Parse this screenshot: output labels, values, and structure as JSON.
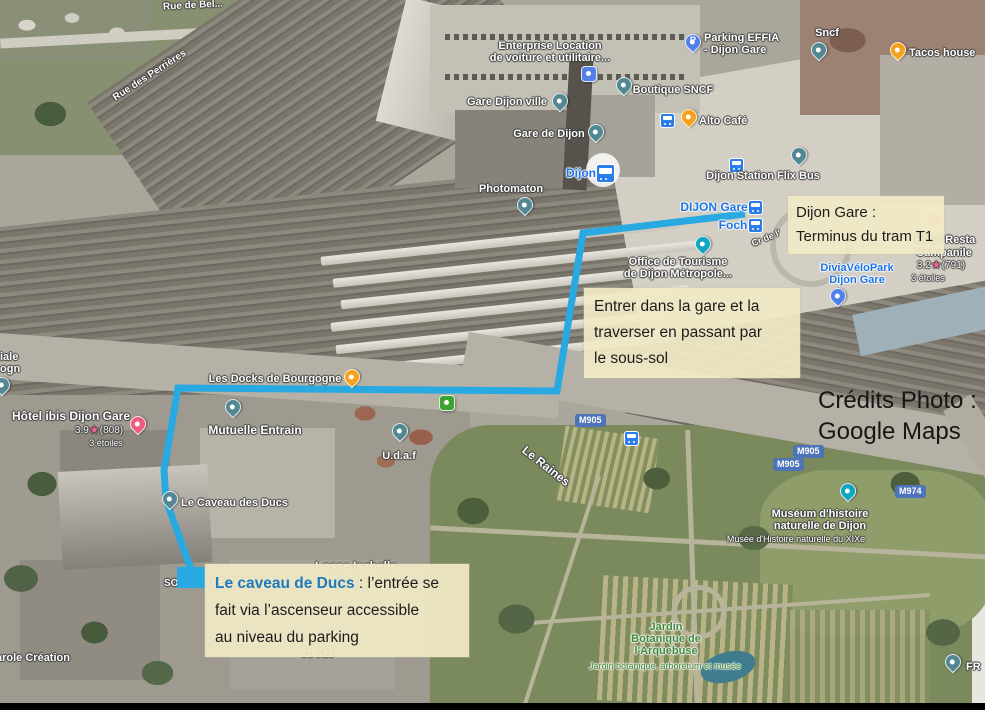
{
  "annotations": {
    "tram": {
      "line1": "Dijon Gare :",
      "line2": "Terminus du tram T1"
    },
    "gare": {
      "line1": "Entrer dans la gare et la",
      "line2": "traverser en passant par",
      "line3": "le sous-sol"
    },
    "caveau": {
      "highlight": "Le caveau de Ducs",
      "after": " : l’entrée se",
      "line2": "fait via l’ascenseur accessible",
      "line3": "au niveau du parking"
    },
    "credits": {
      "line1": "Crédits Photo :",
      "line2": "Google Maps"
    }
  },
  "route": {
    "points": "745,214 583,233 557,391 178,388 164,470 166,500 192,572",
    "color": "#29A9E1",
    "end_square": {
      "x": 177,
      "y": 567,
      "w": 29,
      "h": 21
    }
  },
  "streets": {
    "rue_de_bel": "Rue de Bel...",
    "perrieres": "Rue des Perrières",
    "cr_de": "Cr de l'",
    "raines": "Le Raines",
    "losse": "Losse Isabelle",
    "psy": "psychanalyste",
    "cdg21": "CDG21",
    "carole": "arole Création",
    "frag_so": "SO",
    "frag_rgie": "RGIE",
    "frag_iale": "iale",
    "frag_ogn": "ogn"
  },
  "pois": {
    "enterprise": {
      "l1": "Enterprise Location",
      "l2": "de voiture et utilitaire..."
    },
    "gare_ville": "Gare Dijon ville",
    "gare_dijon": "Gare de Dijon",
    "photomaton": "Photomaton",
    "dijon_station": "Dijon",
    "boutique": "Boutique SNCF",
    "parking": {
      "l1": "Parking EFFIA",
      "l2": "- Dijon Gare",
      "pin_letter": "P"
    },
    "sncf": "Sncf",
    "tacos": "Tacos house",
    "alto": "Alto Café",
    "flixbus": "Dijon Station Flix Bus",
    "tram_terminus": "DIJON Gare",
    "tram_foch": "Foch",
    "tourisme": {
      "l1": "Office de Tourisme",
      "l2": "de Dijon Métropole..."
    },
    "divia": {
      "l1": "DiviaVéloPark",
      "l2": "Dijon Gare"
    },
    "campanile": {
      "frag": "Hôtel Resta",
      "name": "Campanile",
      "rating": "3.2",
      "count": "(791)",
      "sub": "3 étoiles"
    },
    "ibis": {
      "name": "Hôtel ibis Dijon Gare",
      "rating": "3.9",
      "count": "(808)",
      "sub": "3 étoiles"
    },
    "mutuelle": "Mutuelle Entrain",
    "udaf": "U.d.a.f",
    "docks": "Les Docks de Bourgogne",
    "caveau": "Le Caveau des Ducs",
    "museum": {
      "l1": "Muséum d'histoire",
      "l2": "naturelle de Dijon",
      "sub": "Musée d'Histoire naturelle du XIXe"
    },
    "jardin": {
      "l1": "Jardin",
      "l2": "Botanique de",
      "l3": "l'Arquebuse",
      "sub": "Jardin botanique, arboretum et musée"
    },
    "fr": "FR"
  },
  "shields": {
    "m905": "M905",
    "m974": "M974"
  }
}
